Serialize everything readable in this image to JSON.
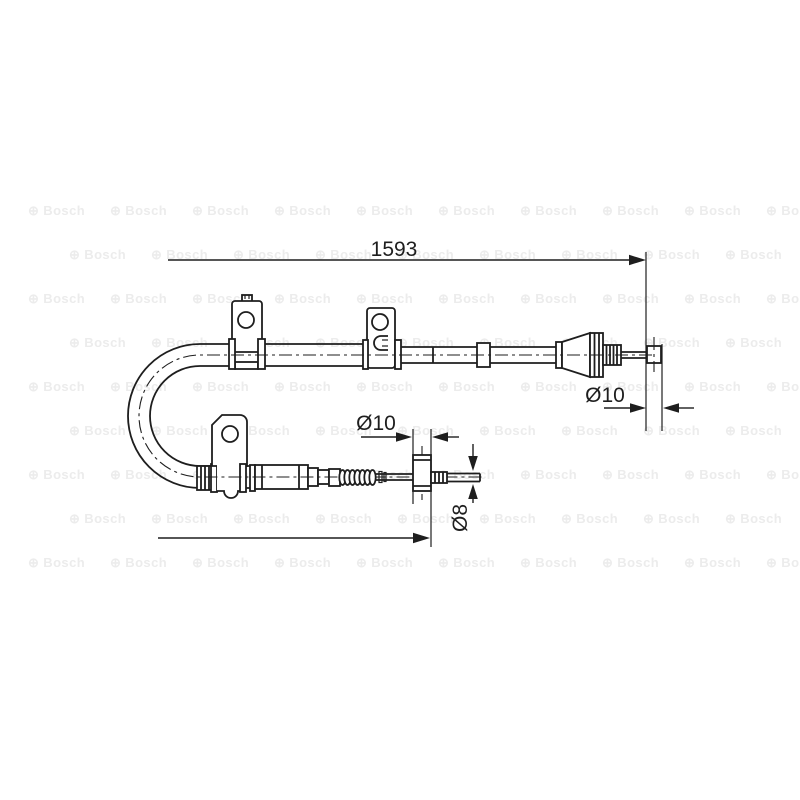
{
  "page": {
    "background": "#ffffff"
  },
  "diagram": {
    "type": "technical-drawing",
    "subject": "parking-brake-cable",
    "labels": {
      "length_total": "1593",
      "dia_upper_end": "Ø10",
      "dia_lower_end": "Ø10",
      "dia_lower_rod": "Ø8"
    },
    "watermark": {
      "symbol": "⊕",
      "brand": "Bosch"
    },
    "colors": {
      "line": "#1e1e1e",
      "watermark": "#ececec",
      "background": "#ffffff"
    }
  }
}
